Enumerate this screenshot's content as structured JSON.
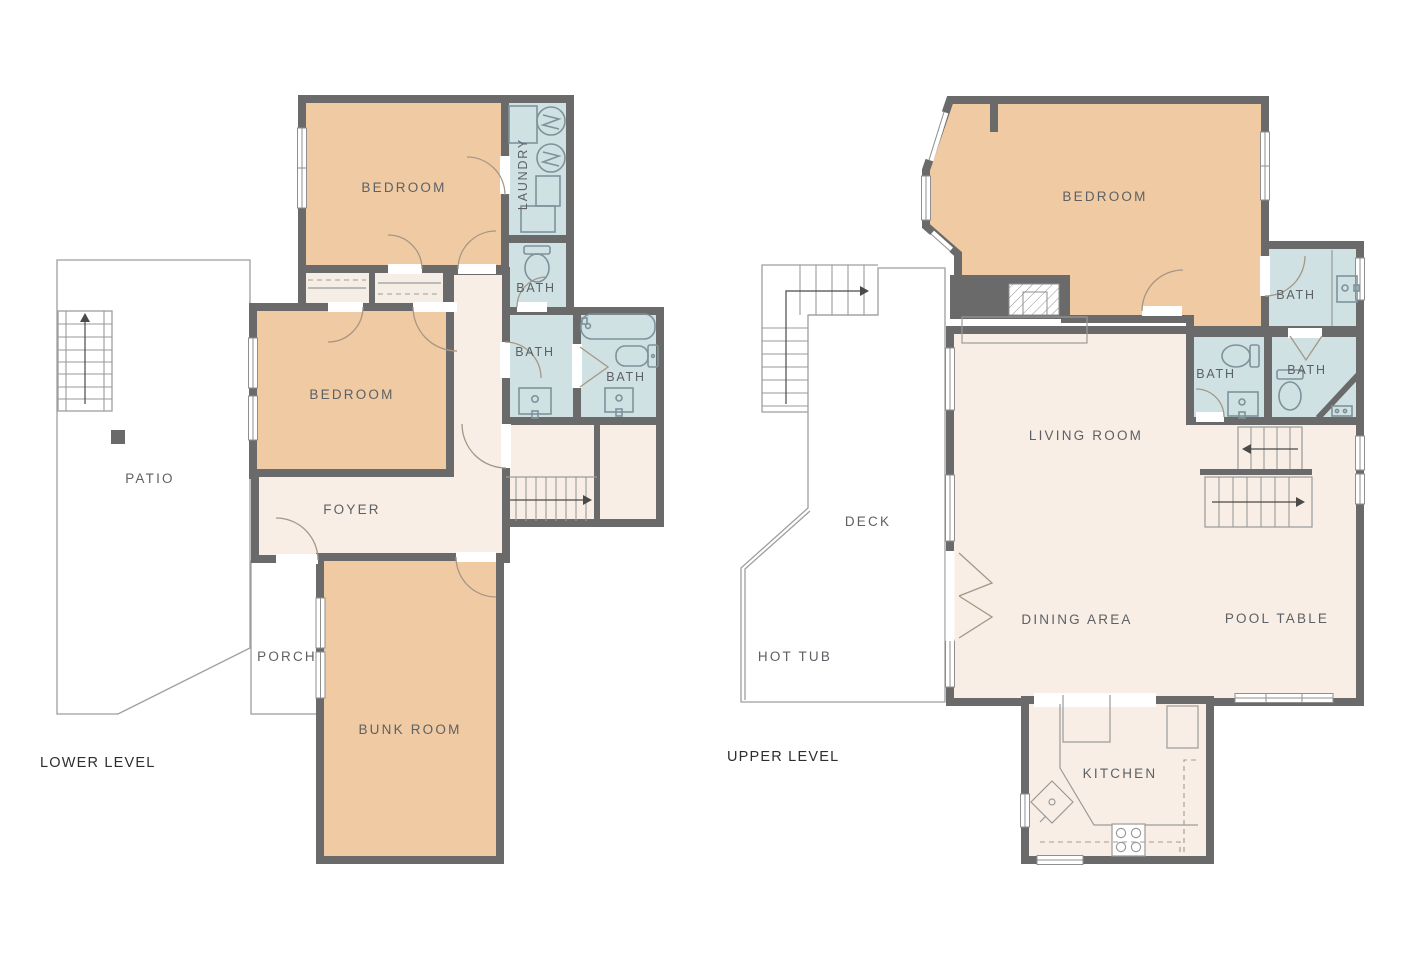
{
  "document": {
    "type": "floor-plan",
    "background": "#FFFFFF"
  },
  "colors": {
    "wall": "#6A6A6A",
    "bedroom": "#F0CAA3",
    "bath": "#CFE1E3",
    "floor": "#F8EEE5",
    "closet": "#F5EEE6",
    "outdoor": "#ECECEC",
    "outline": "#9E9E9E",
    "label": "#5D6165",
    "title": "#2E2E2E"
  },
  "lower_level": {
    "title": "LOWER LEVEL",
    "labels": {
      "bedroom_top": "BEDROOM",
      "laundry": "LAUNDRY",
      "bath_a": "BATH",
      "bedroom_left": "BEDROOM",
      "bath_b": "BATH",
      "bath_c": "BATH",
      "foyer": "FOYER",
      "patio": "PATIO",
      "porch": "PORCH",
      "bunk_room": "BUNK ROOM"
    }
  },
  "upper_level": {
    "title": "UPPER LEVEL",
    "labels": {
      "bedroom": "BEDROOM",
      "bath_top": "BATH",
      "bath_left": "BATH",
      "bath_right": "BATH",
      "living_room": "LIVING ROOM",
      "deck": "DECK",
      "hot_tub": "HOT TUB",
      "dining_area": "DINING AREA",
      "pool_table": "POOL TABLE",
      "kitchen": "KITCHEN"
    }
  }
}
